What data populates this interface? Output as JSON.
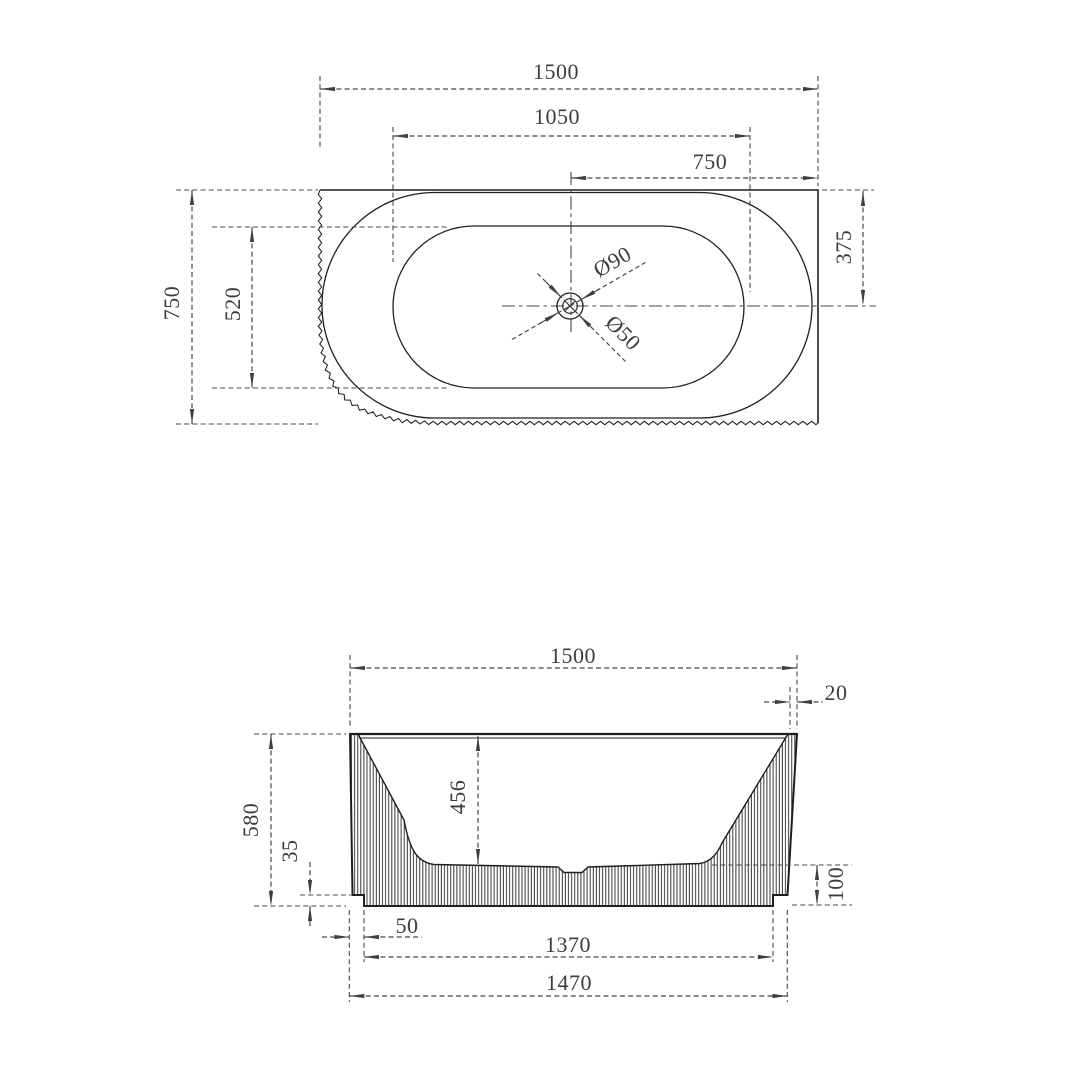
{
  "colors": {
    "background": "#ffffff",
    "outline": "#1f1f1f",
    "dimension": "#474747",
    "text": "#3d3d3d"
  },
  "plan_view": {
    "overall_width": "1500",
    "inner_length": "1050",
    "drain_offset_right": "750",
    "overall_depth": "750",
    "inner_width": "520",
    "drain_offset_back": "375",
    "drain_outer_dia": "Ø90",
    "drain_inner_dia": "Ø50"
  },
  "elevation_view": {
    "overall_width": "1500",
    "rim_taper": "20",
    "overall_height": "580",
    "internal_depth": "456",
    "plinth_gap": "35",
    "base_height": "100",
    "base_inset": "50",
    "base_inner_width": "1370",
    "base_width": "1470"
  }
}
